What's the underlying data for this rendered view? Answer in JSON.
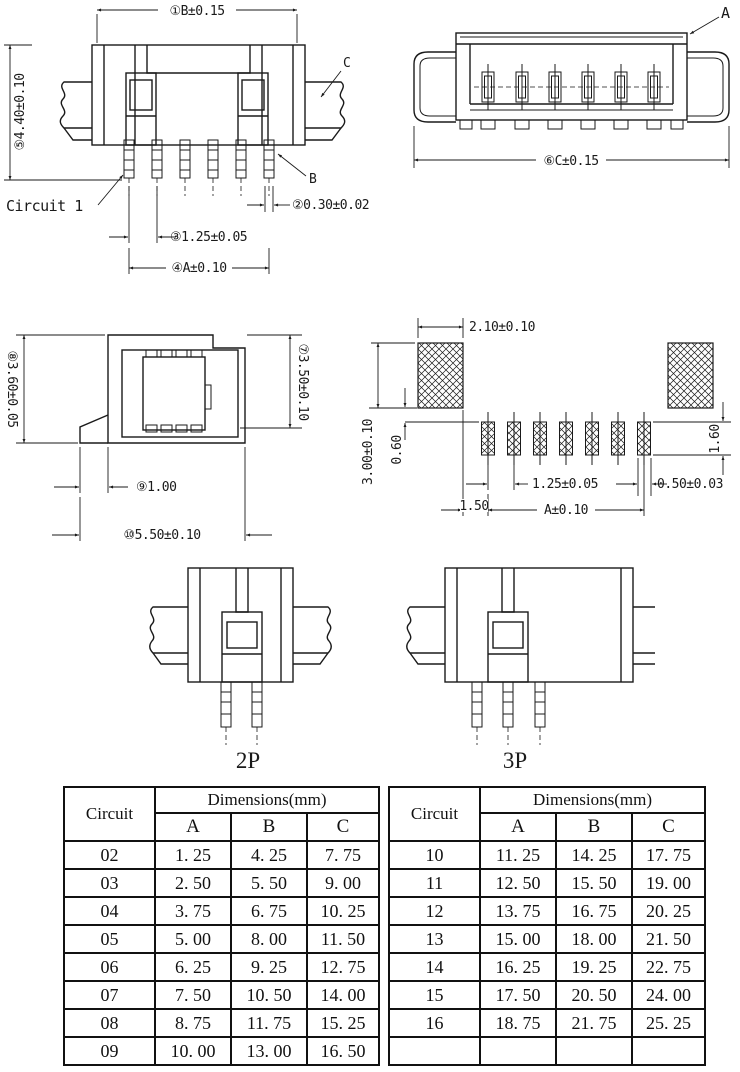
{
  "front_view": {
    "dim_b": "①B±0.15",
    "dim_height": "⑤4.40±0.10",
    "label_c": "C",
    "label_b": "B",
    "circuit1_label": "Circuit 1",
    "dim_pin_width": "②0.30±0.02",
    "dim_pitch": "③1.25±0.05",
    "dim_a": "④A±0.10"
  },
  "top_view": {
    "label_a": "A",
    "dim_c": "⑥C±0.15"
  },
  "side_view": {
    "dim_height_left": "⑧3.60±0.05",
    "dim_height_right": "⑦3.50±0.10",
    "dim_standoff": "⑨1.00",
    "dim_depth": "⑩5.50±0.10"
  },
  "pcb_layout": {
    "dim_pad_width": "2.10±0.10",
    "dim_pad_height": "3.00±0.10",
    "dim_offset": "0.60",
    "dim_signal_pad_height": "1.60",
    "dim_pitch": "1.25±0.05",
    "dim_signal_pad_width": "0.50±0.03",
    "dim_edge_gap": "1.50",
    "dim_a": "A±0.10"
  },
  "variants": {
    "p2": "2P",
    "p3": "3P"
  },
  "tables": {
    "header": {
      "circuit": "Circuit",
      "dimensions": "Dimensions(mm)",
      "col_a": "A",
      "col_b": "B",
      "col_c": "C"
    },
    "left_rows": [
      {
        "circuit": "02",
        "a": "1. 25",
        "b": "4. 25",
        "c": "7. 75"
      },
      {
        "circuit": "03",
        "a": "2. 50",
        "b": "5. 50",
        "c": "9. 00"
      },
      {
        "circuit": "04",
        "a": "3. 75",
        "b": "6. 75",
        "c": "10. 25"
      },
      {
        "circuit": "05",
        "a": "5. 00",
        "b": "8. 00",
        "c": "11. 50"
      },
      {
        "circuit": "06",
        "a": "6. 25",
        "b": "9. 25",
        "c": "12. 75"
      },
      {
        "circuit": "07",
        "a": "7. 50",
        "b": "10. 50",
        "c": "14. 00"
      },
      {
        "circuit": "08",
        "a": "8. 75",
        "b": "11. 75",
        "c": "15. 25"
      },
      {
        "circuit": "09",
        "a": "10. 00",
        "b": "13. 00",
        "c": "16. 50"
      }
    ],
    "right_rows": [
      {
        "circuit": "10",
        "a": "11. 25",
        "b": "14. 25",
        "c": "17. 75"
      },
      {
        "circuit": "11",
        "a": "12. 50",
        "b": "15. 50",
        "c": "19. 00"
      },
      {
        "circuit": "12",
        "a": "13. 75",
        "b": "16. 75",
        "c": "20. 25"
      },
      {
        "circuit": "13",
        "a": "15. 00",
        "b": "18. 00",
        "c": "21. 50"
      },
      {
        "circuit": "14",
        "a": "16. 25",
        "b": "19. 25",
        "c": "22. 75"
      },
      {
        "circuit": "15",
        "a": "17. 50",
        "b": "20. 50",
        "c": "24. 00"
      },
      {
        "circuit": "16",
        "a": "18. 75",
        "b": "21. 75",
        "c": "25. 25"
      },
      {
        "circuit": "",
        "a": "",
        "b": "",
        "c": ""
      }
    ]
  },
  "colors": {
    "line": "#1a1a1a",
    "background": "#ffffff"
  }
}
